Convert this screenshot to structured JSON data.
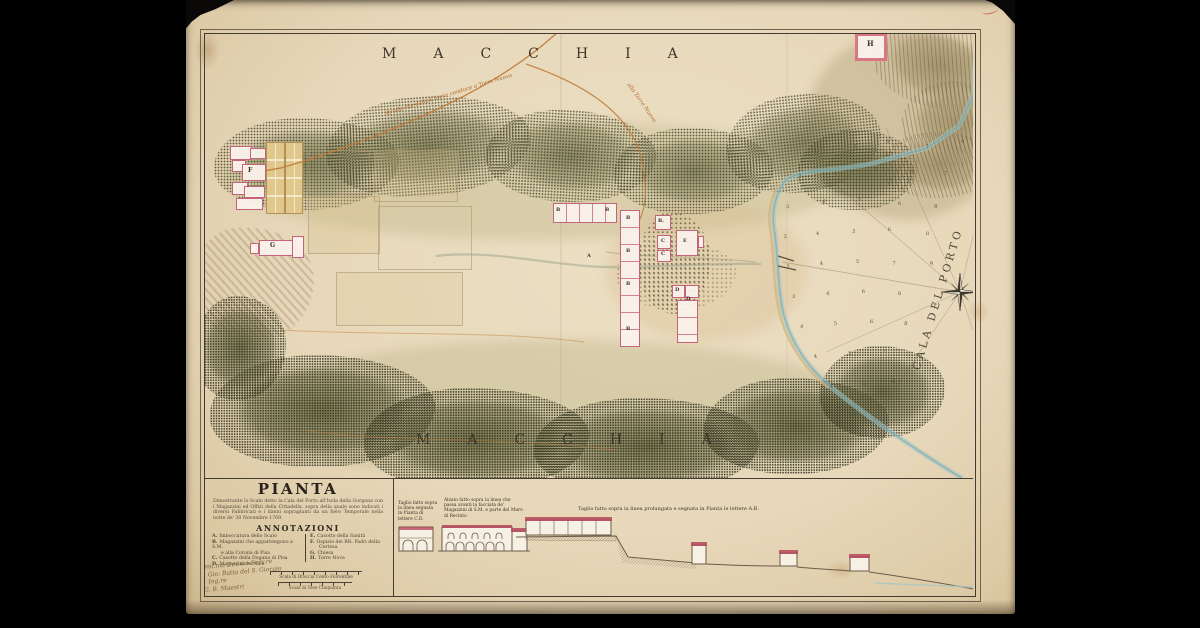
{
  "map": {
    "region_labels": {
      "macchia_top": "MACCHIA",
      "macchia_bottom": "MACCHIA",
      "bay": "CALA DEL PORTO"
    },
    "road_labels": {
      "main": "Strada che dalla Chiesa conduce a Torre Nuova",
      "branch": "alla Torre Nuova"
    },
    "building_letters": [
      {
        "t": "F",
        "x": 62,
        "y": 168,
        "s": 6
      },
      {
        "t": "G",
        "x": 84,
        "y": 243,
        "s": 6
      },
      {
        "t": "H",
        "x": 681,
        "y": 41,
        "s": 7
      },
      {
        "t": "A",
        "x": 401,
        "y": 254,
        "s": 5
      },
      {
        "t": "B",
        "x": 370,
        "y": 208,
        "s": 5
      },
      {
        "t": "B",
        "x": 419,
        "y": 208,
        "s": 5
      },
      {
        "t": "B",
        "x": 440,
        "y": 216,
        "s": 5
      },
      {
        "t": "B",
        "x": 440,
        "y": 249,
        "s": 5
      },
      {
        "t": "B",
        "x": 440,
        "y": 282,
        "s": 5
      },
      {
        "t": "B",
        "x": 440,
        "y": 327,
        "s": 5
      },
      {
        "t": "B.",
        "x": 472,
        "y": 219,
        "s": 5
      },
      {
        "t": "C",
        "x": 475,
        "y": 239,
        "s": 5
      },
      {
        "t": "C",
        "x": 475,
        "y": 252,
        "s": 5
      },
      {
        "t": "E",
        "x": 497,
        "y": 239,
        "s": 5
      },
      {
        "t": "D",
        "x": 489,
        "y": 288,
        "s": 5
      },
      {
        "t": "D",
        "x": 500,
        "y": 297,
        "s": 5
      }
    ],
    "soundings": [
      {
        "v": "4",
        "x": 628,
        "y": 150
      },
      {
        "v": "5",
        "x": 668,
        "y": 145
      },
      {
        "v": "6",
        "x": 700,
        "y": 140
      },
      {
        "v": "7",
        "x": 740,
        "y": 145
      },
      {
        "v": "8",
        "x": 775,
        "y": 140
      },
      {
        "v": "3",
        "x": 612,
        "y": 175
      },
      {
        "v": "4",
        "x": 648,
        "y": 172
      },
      {
        "v": "5",
        "x": 688,
        "y": 168
      },
      {
        "v": "6",
        "x": 724,
        "y": 170
      },
      {
        "v": "7",
        "x": 758,
        "y": 172
      },
      {
        "v": "3",
        "x": 600,
        "y": 205
      },
      {
        "v": "4",
        "x": 636,
        "y": 200
      },
      {
        "v": "5",
        "x": 672,
        "y": 198
      },
      {
        "v": "6",
        "x": 712,
        "y": 202
      },
      {
        "v": "8",
        "x": 748,
        "y": 205
      },
      {
        "v": "2",
        "x": 598,
        "y": 235
      },
      {
        "v": "4",
        "x": 630,
        "y": 232
      },
      {
        "v": "5",
        "x": 666,
        "y": 230
      },
      {
        "v": "6",
        "x": 702,
        "y": 228
      },
      {
        "v": "8",
        "x": 740,
        "y": 232
      },
      {
        "v": "3",
        "x": 600,
        "y": 265
      },
      {
        "v": "4",
        "x": 634,
        "y": 262
      },
      {
        "v": "5",
        "x": 670,
        "y": 260
      },
      {
        "v": "7",
        "x": 706,
        "y": 262
      },
      {
        "v": "9",
        "x": 744,
        "y": 262
      },
      {
        "v": "3",
        "x": 606,
        "y": 295
      },
      {
        "v": "4",
        "x": 640,
        "y": 292
      },
      {
        "v": "6",
        "x": 676,
        "y": 290
      },
      {
        "v": "8",
        "x": 712,
        "y": 292
      },
      {
        "v": "4",
        "x": 614,
        "y": 325
      },
      {
        "v": "5",
        "x": 648,
        "y": 322
      },
      {
        "v": "6",
        "x": 684,
        "y": 320
      },
      {
        "v": "8",
        "x": 718,
        "y": 322
      },
      {
        "v": "4",
        "x": 628,
        "y": 355
      },
      {
        "v": "5",
        "x": 662,
        "y": 352
      },
      {
        "v": "7",
        "x": 696,
        "y": 350
      },
      {
        "v": "4",
        "x": 644,
        "y": 385
      },
      {
        "v": "5",
        "x": 676,
        "y": 382
      },
      {
        "v": "6",
        "x": 706,
        "y": 380
      },
      {
        "v": "4",
        "x": 668,
        "y": 412
      },
      {
        "v": "5",
        "x": 698,
        "y": 408
      }
    ]
  },
  "title_block": {
    "title": "PIANTA",
    "subtitle": "Dimostrante lo Scalo detto la Cala del Porto all'Isola della Gorgona con i Magazzini ed Offizi della Cittadella, sopra della quale sono indicati i diversi Fabbricati e i danni sopragiunti da un fiero Temporale nella notte de' 30 Novembre 1769.",
    "annotations_heading": "ANNOTAZIONI",
    "annotations_left": [
      {
        "k": "A.",
        "t": "Imboccatura dello Scalo"
      },
      {
        "k": "B.",
        "t": "Magazzini che appartengono a S.M."
      },
      {
        "k": "",
        "t": "e alla Corona di Pisa"
      },
      {
        "k": "C.",
        "t": "Casotto della Dogana di Pisa"
      },
      {
        "k": "D.",
        "t": "Magazzini del Sale"
      }
    ],
    "annotations_right": [
      {
        "k": "E.",
        "t": "Casotto della Sanità"
      },
      {
        "k": "F.",
        "t": "Ospizio dei RR. Padri della"
      },
      {
        "k": "",
        "t": "Certosa"
      },
      {
        "k": "G.",
        "t": "Chiesa"
      },
      {
        "k": "H.",
        "t": "Torre Nova"
      }
    ],
    "signature_lines": [
      "Umil.mo Dev.mo Serv.re",
      "Gio: Batta del S. Giorgio Ing.re",
      "G. B. Maestri"
    ],
    "scale_bar_1": "Scala di Braccia Cento Fiorentine",
    "scale_bar_2": "Scala di Tese Cinquanta"
  },
  "sections_panel": {
    "caption_section_cd": "Taglio fatto sopra la linea segnata in Pianta di lettere C.D.",
    "caption_elevation": "Alzato fatto sopra la linea che passa avanti la facciata de' Magazzini di S.M. e parte del Muro di Recinto",
    "caption_profile_ab": "Taglio fatto sopra la linea prolungata e segnata in Pianta le lettere A.B."
  },
  "colors": {
    "paper": "#e8dabc",
    "building_outline": "#c4647a",
    "road": "#c07a3a",
    "shore_blue": "#9cc4c6",
    "roof_red": "#b5485a",
    "ink": "#3c3226"
  }
}
